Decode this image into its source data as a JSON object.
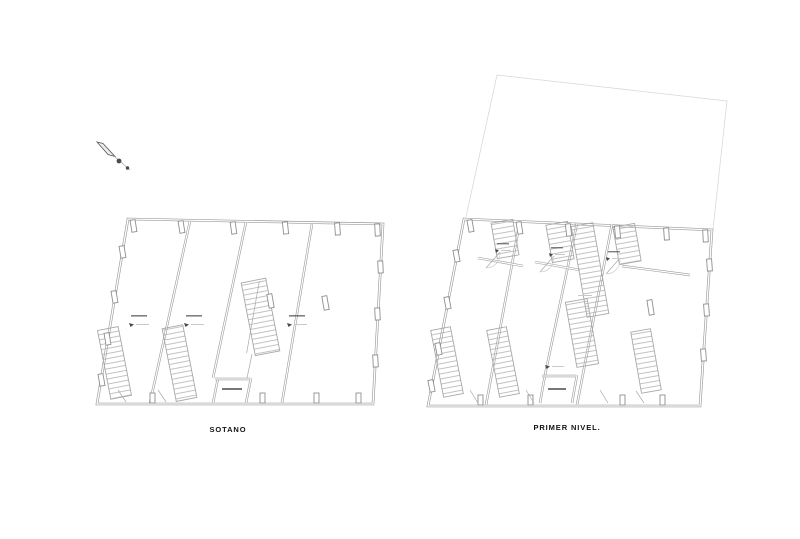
{
  "canvas": {
    "width": 800,
    "height": 539,
    "background": "#ffffff"
  },
  "plans": {
    "left": {
      "title": "SOTANO"
    },
    "right": {
      "title": "PRIMER NIVEL."
    }
  },
  "north_arrow": {
    "icon": "north-arrow-icon"
  },
  "colors": {
    "paper": "#ffffff",
    "wall": "#9a9a9a",
    "stair": "#a8a8a8",
    "faint": "#d9d9d9",
    "column": "#8f8f8f",
    "marker_dark": "#4a4a4a",
    "marker_light": "#c9c9c9",
    "title": "#141414"
  }
}
